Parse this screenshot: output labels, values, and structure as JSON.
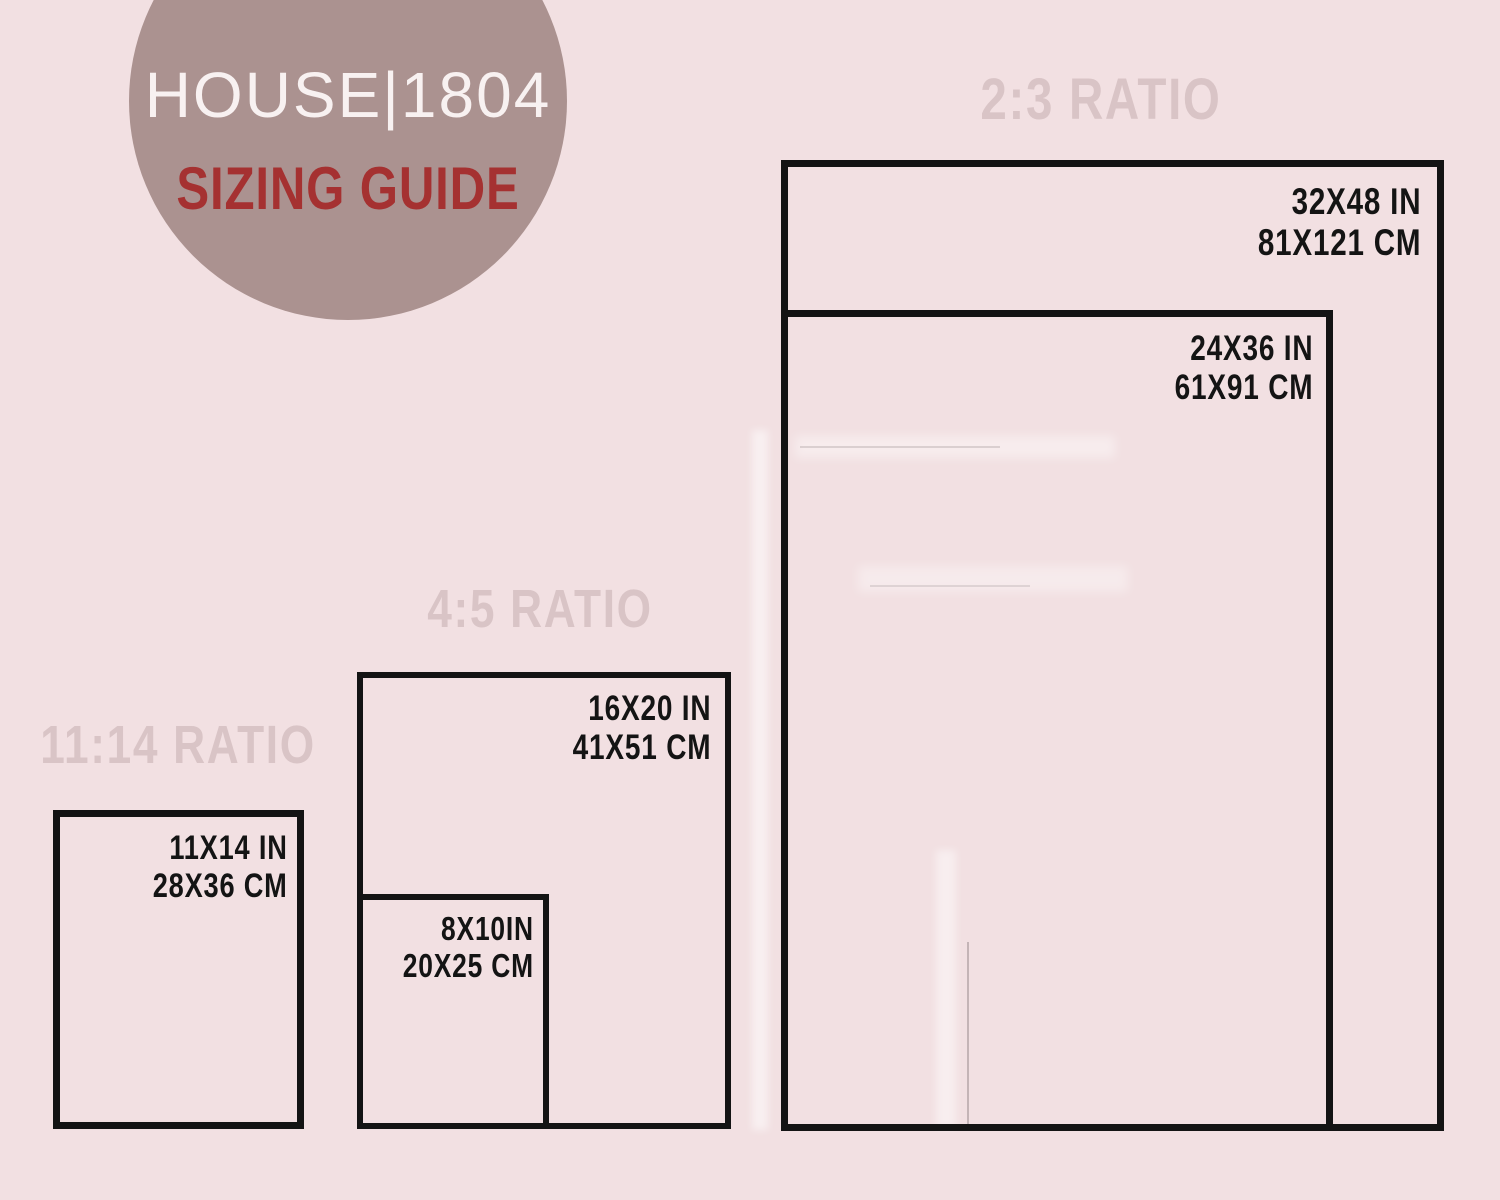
{
  "theme": {
    "background": "#f2e0e2",
    "line_color": "#141414",
    "header_color": "#d9c4c6",
    "circle_color": "#ab9290",
    "brand_color": "#f8f1f1",
    "accent_red": "#a53131"
  },
  "logo": {
    "brand": "HOUSE|1804",
    "subtitle": "SIZING GUIDE"
  },
  "sections": [
    {
      "id": "2-3",
      "header": "2:3 RATIO",
      "sizes": [
        {
          "inches": "32X48 IN",
          "cm": "81X121 CM"
        },
        {
          "inches": "24X36 IN",
          "cm": "61X91 CM"
        }
      ]
    },
    {
      "id": "4-5",
      "header": "4:5 RATIO",
      "sizes": [
        {
          "inches": "16X20 IN",
          "cm": "41X51 CM"
        },
        {
          "inches": "8X10IN",
          "cm": "20X25 CM"
        }
      ]
    },
    {
      "id": "11-14",
      "header": "11:14 RATIO",
      "sizes": [
        {
          "inches": "11X14 IN",
          "cm": "28X36 CM"
        }
      ]
    }
  ]
}
